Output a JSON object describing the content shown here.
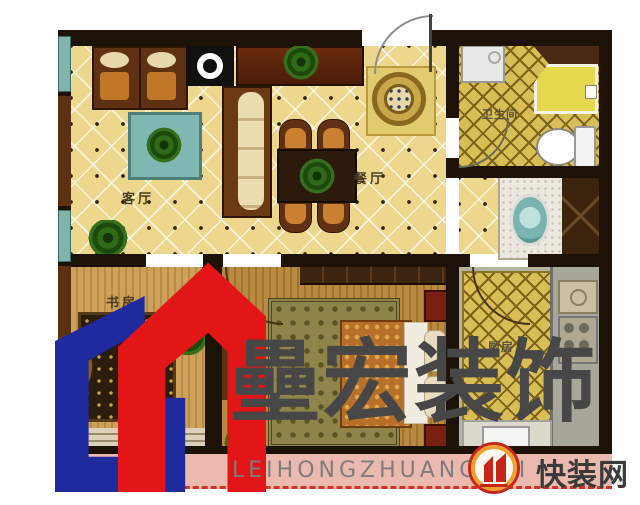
{
  "rooms": {
    "living": {
      "label": "客厅"
    },
    "dining": {
      "label": "餐厅"
    },
    "bathroom": {
      "label": "卫生间"
    },
    "study": {
      "label": "书房"
    },
    "kitchen": {
      "label": "厨房"
    }
  },
  "watermark": {
    "brand_cn": "壘宏装饰",
    "brand_pinyin": "LEIHONGZHUANGSHI",
    "site_name": "快装网",
    "colors": {
      "logo_blue": "#1f2a9f",
      "logo_red": "#e31617",
      "badge_red": "#c8251a",
      "badge_orange": "#f0a030",
      "text_gray": "#4a4a4a"
    }
  },
  "palette": {
    "wall": "#1c1208",
    "living_floor": "#ecd78d",
    "bath_floor": "#d9bd55",
    "study_floor": "#c69a52",
    "balcony": "#ecb9ae"
  }
}
